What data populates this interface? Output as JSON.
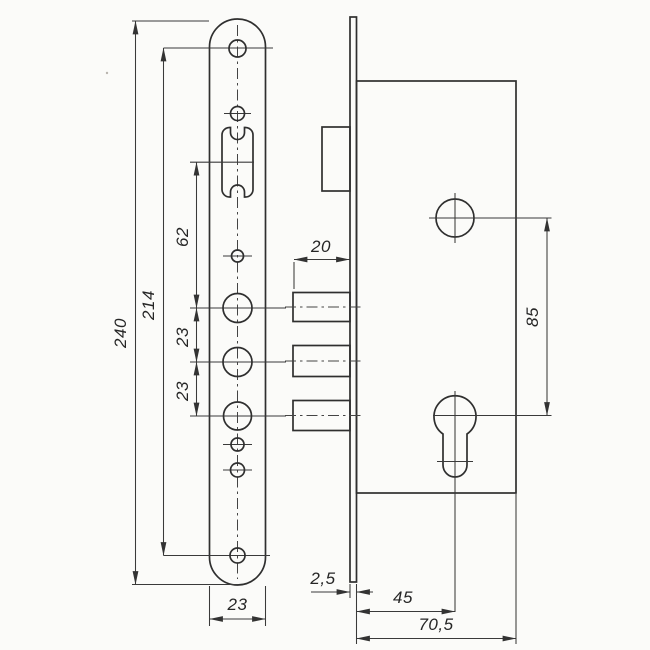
{
  "diagram": {
    "dimensions": {
      "overall_height": "240",
      "screw_hole_centers": "214",
      "latch_to_first_bolt": "62",
      "bolt_spacing_upper": "23",
      "bolt_spacing_lower": "23",
      "faceplate_width": "23",
      "bolt_throw": "20",
      "spindle_to_cylinder": "85",
      "faceplate_thickness": "2,5",
      "backset": "45",
      "body_depth": "70,5"
    },
    "colors": {
      "outline": "#2f2f2f",
      "dimension_line": "#3a3a3a",
      "background": "#fbfbf9"
    }
  }
}
